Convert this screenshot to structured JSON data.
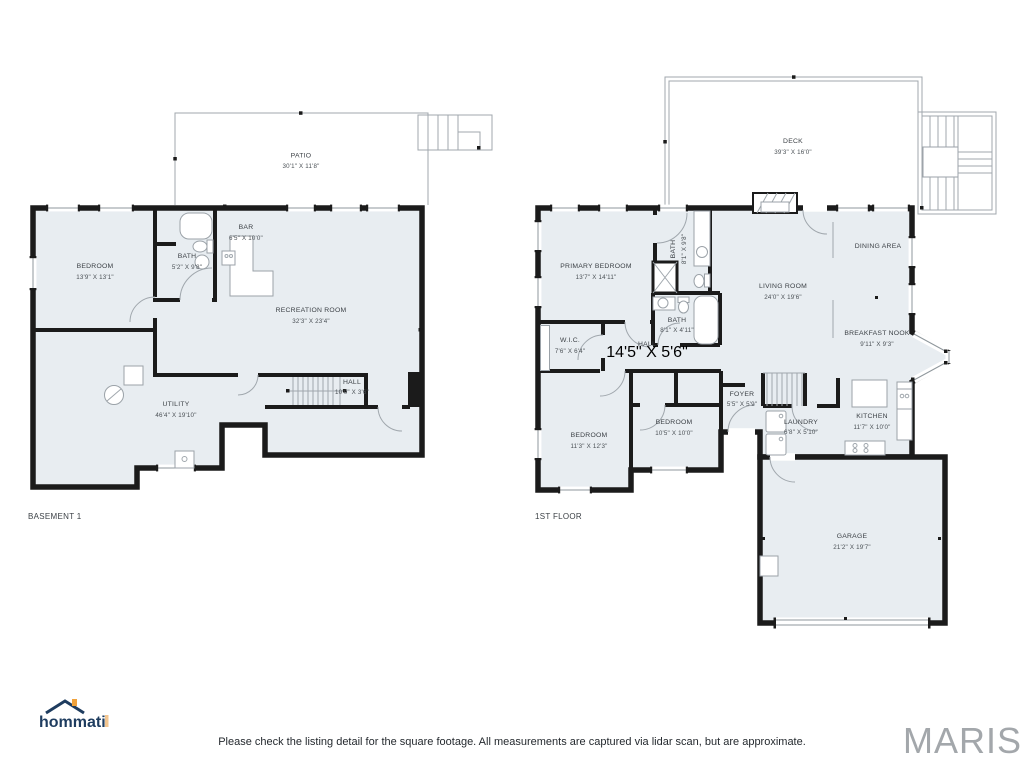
{
  "colors": {
    "room_fill": "#e8edf1",
    "wall": "#1b1b1b",
    "thin_line": "#a0a7ad",
    "label_text": "#3c4146",
    "hommati_navy": "#1e3c5f",
    "hommati_orange": "#f0a23c",
    "maris_gray": "#a3a7ab"
  },
  "basement": {
    "floor_label": "BASEMENT 1",
    "rooms": [
      {
        "name": "PATIO",
        "dims": "30'1\" X 11'8\""
      },
      {
        "name": "BEDROOM",
        "dims": "13'9\" X 13'1\""
      },
      {
        "name": "BATH",
        "dims": "5'2\" X 9'8\""
      },
      {
        "name": "BAR",
        "dims": "6'5\" X 10'0\""
      },
      {
        "name": "RECREATION ROOM",
        "dims": "32'3\" X 23'4\""
      },
      {
        "name": "UTILITY",
        "dims": "46'4\" X 19'10\""
      },
      {
        "name": "HALL",
        "dims": "10'0\" X 3'6\""
      }
    ]
  },
  "first_floor": {
    "floor_label": "1ST FLOOR",
    "rooms": [
      {
        "name": "DECK",
        "dims": "39'3\" X 16'0\""
      },
      {
        "name": "PRIMARY BEDROOM",
        "dims": "13'7\" X 14'11\""
      },
      {
        "name": "BATH",
        "dims": "8'1\" X 9'8\""
      },
      {
        "name": "BATH",
        "dims": "8'1\" X 4'11\""
      },
      {
        "name": "W.I.C.",
        "dims": "7'6\" X 6'4\""
      },
      {
        "name": "HALL",
        "dims": "14'5\" X 5'6\""
      },
      {
        "name": "DINING AREA",
        "dims": ""
      },
      {
        "name": "LIVING ROOM",
        "dims": "24'0\" X 19'6\""
      },
      {
        "name": "BREAKFAST NOOK",
        "dims": "9'11\" X 9'3\""
      },
      {
        "name": "FOYER",
        "dims": "5'5\" X 5'9\""
      },
      {
        "name": "KITCHEN",
        "dims": "11'7\" X 10'0\""
      },
      {
        "name": "LAUNDRY",
        "dims": "6'8\" X 5'10\""
      },
      {
        "name": "BEDROOM",
        "dims": "11'3\" X 12'3\""
      },
      {
        "name": "BEDROOM",
        "dims": "10'5\" X 10'0\""
      },
      {
        "name": "GARAGE",
        "dims": "21'2\" X 19'7\""
      }
    ]
  },
  "footer": {
    "brand_left": "hommati",
    "brand_right": "MARIS",
    "disclaimer": "Please check the listing detail for the square footage. All measurements are captured via lidar scan, but are approximate."
  }
}
